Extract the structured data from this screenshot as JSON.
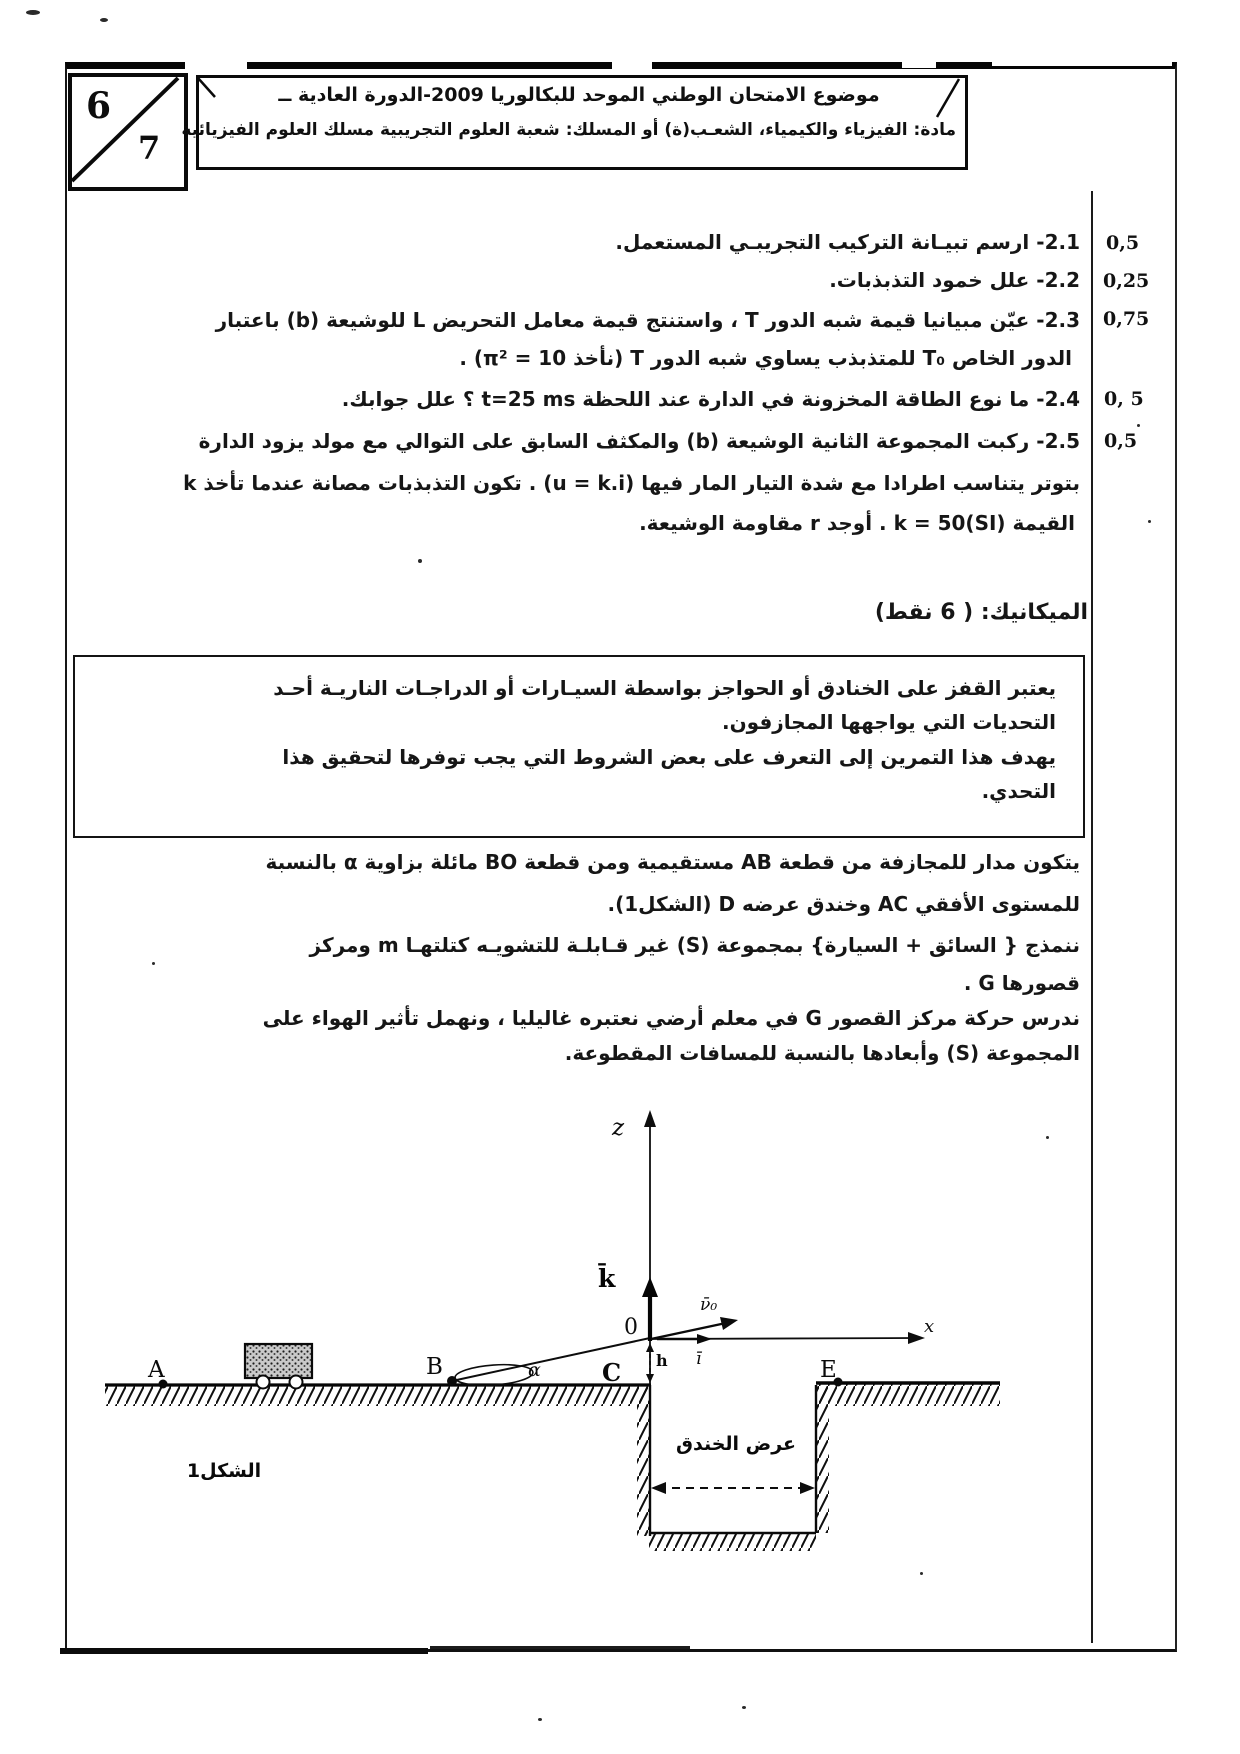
{
  "page_corner": {
    "current_page": "6",
    "total_pages": "7"
  },
  "header": {
    "line1": "موضوع الامتحان الوطني الموحد للبكالوريا 2009-الدورة العادية ــ",
    "line2": "مادة: الفيزياء والكيمياء، الشعـب(ة) أو المسلك: شعبة العلوم التجريبية مسلك العلوم الفيزيائية"
  },
  "questions": [
    {
      "mark": "0,5",
      "lines": [
        "2.1- ارسم تبيـانة التركيب التجريبـي المستعمل."
      ]
    },
    {
      "mark": "0,25",
      "lines": [
        "2.2- علل خمود التذبذبات."
      ]
    },
    {
      "mark": "0,75",
      "lines": [
        "2.3- عيّن مبيانيا قيمة شبه الدور T ، واستنتج قيمة معامل التحريض L للوشيعة (b) باعتبار",
        "الدور الخاص T₀ للمتذبذب يساوي شبه الدور T   (نأخذ π² = 10) ."
      ]
    },
    {
      "mark": "0, 5",
      "lines": [
        "2.4- ما نوع الطاقة المخزونة في الدارة عند اللحظة t=25 ms ؟ علل جوابك."
      ]
    },
    {
      "mark": "0,5",
      "lines": [
        "2.5- ركبت المجموعة الثانية الوشيعة (b) والمكثف السابق على التوالي مع مولد يزود الدارة",
        "بتوتر يتناسب اطرادا مع شدة التيار المار فيها (u = k.i) . تكون التذبذبات مصانة عندما تأخذ k",
        "القيمة k = 50(SI) . أوجد r مقاومة الوشيعة."
      ]
    }
  ],
  "mechanics": {
    "title": "الميكانيك: ( 6 نقط)",
    "intro_box": [
      "يعتبر القفز على الخنادق أو الحواجز بواسطة السيـارات أو الدراجـات الناريـة أحـد",
      "التحديات التي يواجهها المجازفون.",
      "يهدف هذا التمرين إلى التعرف على بعض الشروط التي يجب توفرها لتحقيق هذا",
      "التحدي."
    ],
    "paragraph1": [
      "يتكون مدار للمجازفة من قطعة AB مستقيمية ومن قطعة BO مائلة بزاوية α بالنسبة",
      "للمستوى الأفقي AC وخندق عرضه D (الشكل1).",
      "ننمذج { السائق + السيارة}  بمجموعة (S)  غير قـابلـة للتشويـه كتلتهـا m ومركز",
      "قصورها G ."
    ],
    "paragraph2": [
      "ندرس حركة مركز القصور G في معلم أرضي نعتبره غاليليا ، ونهمل تأثير الهواء على",
      "المجموعة (S) وأبعادها بالنسبة للمسافات المقطوعة."
    ]
  },
  "figure": {
    "caption": "الشكل1",
    "trench_width_label": "عرض الخندق",
    "z_axis": "z",
    "x_axis": "x",
    "origin": "0",
    "k_vector": "k̄",
    "i_vector": "ī",
    "v0_vector": "ν̄₀",
    "point_A": "A",
    "point_B": "B",
    "point_C": "C",
    "point_E": "E",
    "angle_alpha": "α",
    "height_h": "h"
  }
}
